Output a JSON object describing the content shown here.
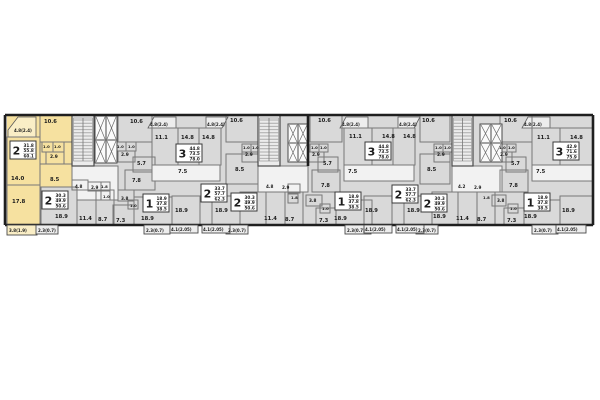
{
  "meta": {
    "description": "Residential building floor plan with highlighted apartment",
    "canvas": {
      "w": 600,
      "h": 400
    }
  },
  "colors": {
    "background": "#ffffff",
    "room_fill": "#d9d9d9",
    "highlight_fill": "#f6e1a0",
    "highlight_balcony_fill": "#faeec6",
    "white_room_fill": "#f2f2f2",
    "balcony_fill": "#ededed",
    "core_fill": "#ececec",
    "outer_wall": "#1f1f1f",
    "partition": "#787878",
    "label_color": "#1c1c1c"
  },
  "plan": {
    "outline": {
      "x": 5,
      "y": 115,
      "w": 588,
      "h": 110
    },
    "highlight": {
      "points": "7,115 72,115 72,200 40,200 40,225 7,225"
    },
    "walls": [
      [
        5,
        115,
        593,
        115
      ],
      [
        5,
        225,
        593,
        225
      ],
      [
        5,
        115,
        5,
        225
      ],
      [
        593,
        115,
        593,
        225
      ],
      [
        308,
        115,
        308,
        166
      ]
    ],
    "rooms": [
      [
        7,
        137,
        33,
        48,
        0
      ],
      [
        40,
        115,
        32,
        27,
        0
      ],
      [
        42,
        142,
        11,
        10,
        0
      ],
      [
        53,
        142,
        11,
        10,
        0
      ],
      [
        46,
        152,
        18,
        12,
        0
      ],
      [
        40,
        164,
        32,
        36,
        0
      ],
      [
        7,
        185,
        33,
        40,
        0
      ],
      [
        72,
        166,
        46,
        34,
        1
      ],
      [
        41,
        187,
        36,
        38,
        2
      ],
      [
        77,
        190,
        19,
        35,
        0
      ],
      [
        96,
        190,
        18,
        35,
        0
      ],
      [
        72,
        180,
        16,
        10,
        0
      ],
      [
        88,
        182,
        13,
        9,
        0
      ],
      [
        101,
        182,
        9,
        9,
        0
      ],
      [
        101,
        191,
        9,
        9,
        0
      ],
      [
        118,
        190,
        16,
        11,
        0
      ],
      [
        128,
        200,
        10,
        9,
        0
      ],
      [
        113,
        205,
        21,
        20,
        0
      ],
      [
        134,
        197,
        38,
        28,
        0
      ],
      [
        125,
        170,
        30,
        20,
        0
      ],
      [
        118,
        115,
        34,
        27,
        0
      ],
      [
        116,
        142,
        10,
        9,
        0
      ],
      [
        126,
        142,
        10,
        9,
        0
      ],
      [
        118,
        151,
        17,
        11,
        0
      ],
      [
        133,
        157,
        22,
        15,
        0
      ],
      [
        152,
        128,
        26,
        37,
        0
      ],
      [
        178,
        128,
        21,
        37,
        0
      ],
      [
        199,
        128,
        22,
        37,
        0
      ],
      [
        152,
        165,
        68,
        16,
        1
      ],
      [
        172,
        196,
        28,
        29,
        0
      ],
      [
        212,
        196,
        28,
        29,
        0
      ],
      [
        226,
        115,
        32,
        27,
        0
      ],
      [
        242,
        144,
        9,
        8,
        0
      ],
      [
        251,
        144,
        9,
        8,
        0
      ],
      [
        242,
        152,
        16,
        10,
        0
      ],
      [
        226,
        154,
        32,
        30,
        0
      ],
      [
        240,
        192,
        26,
        33,
        0
      ],
      [
        266,
        192,
        19,
        33,
        0
      ],
      [
        285,
        192,
        18,
        33,
        0
      ],
      [
        264,
        182,
        17,
        10,
        0
      ],
      [
        281,
        184,
        12,
        8,
        0
      ],
      [
        258,
        166,
        50,
        26,
        1
      ],
      [
        310,
        115,
        32,
        27,
        0
      ],
      [
        310,
        144,
        9,
        8,
        0
      ],
      [
        319,
        144,
        9,
        8,
        0
      ],
      [
        308,
        152,
        16,
        10,
        0
      ],
      [
        318,
        157,
        20,
        15,
        0
      ],
      [
        344,
        128,
        28,
        37,
        0
      ],
      [
        372,
        128,
        21,
        37,
        0
      ],
      [
        393,
        128,
        22,
        37,
        0
      ],
      [
        344,
        165,
        70,
        16,
        1
      ],
      [
        312,
        170,
        28,
        22,
        0
      ],
      [
        288,
        184,
        12,
        9,
        0
      ],
      [
        288,
        194,
        10,
        9,
        0
      ],
      [
        306,
        195,
        16,
        11,
        0
      ],
      [
        320,
        204,
        10,
        9,
        0
      ],
      [
        316,
        208,
        20,
        17,
        0
      ],
      [
        336,
        200,
        36,
        25,
        0
      ],
      [
        364,
        196,
        28,
        29,
        0
      ],
      [
        404,
        196,
        28,
        29,
        0
      ],
      [
        420,
        115,
        30,
        27,
        0
      ],
      [
        434,
        144,
        9,
        8,
        0
      ],
      [
        443,
        144,
        9,
        8,
        0
      ],
      [
        434,
        152,
        16,
        10,
        0
      ],
      [
        420,
        154,
        30,
        30,
        0
      ],
      [
        432,
        192,
        26,
        33,
        0
      ],
      [
        458,
        192,
        19,
        33,
        0
      ],
      [
        477,
        192,
        18,
        33,
        0
      ],
      [
        456,
        182,
        17,
        10,
        0
      ],
      [
        473,
        184,
        12,
        8,
        0
      ],
      [
        452,
        166,
        50,
        26,
        1
      ],
      [
        500,
        115,
        32,
        27,
        0
      ],
      [
        498,
        144,
        9,
        8,
        0
      ],
      [
        507,
        144,
        9,
        8,
        0
      ],
      [
        496,
        152,
        16,
        10,
        0
      ],
      [
        506,
        157,
        20,
        15,
        0
      ],
      [
        532,
        128,
        28,
        37,
        0
      ],
      [
        560,
        128,
        33,
        37,
        0
      ],
      [
        532,
        165,
        61,
        16,
        1
      ],
      [
        500,
        170,
        28,
        22,
        0
      ],
      [
        492,
        195,
        14,
        11,
        0
      ],
      [
        508,
        204,
        10,
        9,
        0
      ],
      [
        504,
        208,
        20,
        17,
        0
      ],
      [
        524,
        200,
        36,
        25,
        0
      ],
      [
        560,
        196,
        33,
        29,
        0
      ]
    ],
    "stairs": [
      [
        72,
        115,
        22,
        51
      ],
      [
        258,
        115,
        22,
        51
      ],
      [
        452,
        115,
        21,
        51
      ]
    ],
    "elevators": [
      [
        95,
        116,
        11,
        24
      ],
      [
        106,
        116,
        11,
        24
      ],
      [
        95,
        140,
        11,
        23
      ],
      [
        106,
        140,
        11,
        23
      ],
      [
        288,
        124,
        10,
        19
      ],
      [
        298,
        124,
        10,
        19
      ],
      [
        288,
        143,
        10,
        19
      ],
      [
        298,
        143,
        10,
        19
      ],
      [
        480,
        124,
        11,
        19
      ],
      [
        491,
        124,
        11,
        19
      ],
      [
        480,
        143,
        11,
        19
      ],
      [
        491,
        143,
        11,
        19
      ]
    ],
    "top_balconies": [
      {
        "points": "8,137 8,130 18,117 36,117 36,137",
        "type": "y"
      },
      {
        "points": "148,128 154,117 176,117 176,128",
        "type": "b"
      },
      {
        "points": "206,128 206,117 228,117 222,128",
        "type": "b"
      },
      {
        "points": "340,128 346,117 368,117 368,128",
        "type": "b"
      },
      {
        "points": "398,128 398,117 420,117 414,128",
        "type": "b"
      },
      {
        "points": "522,128 528,117 550,117 550,128",
        "type": "b"
      }
    ],
    "bottom_balconies": [
      [
        7,
        225,
        30,
        10,
        "y"
      ],
      [
        36,
        225,
        22,
        9,
        "p"
      ],
      [
        144,
        225,
        26,
        9,
        "p"
      ],
      [
        226,
        225,
        22,
        9,
        "p"
      ],
      [
        345,
        225,
        26,
        9,
        "p"
      ],
      [
        416,
        225,
        22,
        9,
        "p"
      ],
      [
        532,
        225,
        26,
        9,
        "p"
      ],
      [
        170,
        225,
        28,
        8,
        "l"
      ],
      [
        202,
        225,
        28,
        8,
        "l"
      ],
      [
        364,
        225,
        28,
        8,
        "l"
      ],
      [
        396,
        225,
        28,
        8,
        "l"
      ],
      [
        556,
        225,
        30,
        8,
        "l"
      ]
    ],
    "labels": [
      [
        44,
        123,
        "10.6",
        5.2
      ],
      [
        130,
        123,
        "10.6",
        5.2
      ],
      [
        230,
        122,
        "10.6",
        5.2
      ],
      [
        318,
        122,
        "10.6",
        5.2
      ],
      [
        422,
        122,
        "10.6",
        5.2
      ],
      [
        504,
        122,
        "10.6",
        5.2
      ],
      [
        11,
        180,
        "14.0",
        5.4
      ],
      [
        12,
        203,
        "17.8",
        5.4
      ],
      [
        155,
        139,
        "11.1",
        5.2
      ],
      [
        349,
        138,
        "11.1",
        5.2
      ],
      [
        537,
        139,
        "11.1",
        5.2
      ],
      [
        181,
        139,
        "14.8",
        5.2
      ],
      [
        202,
        139,
        "14.8",
        5.2
      ],
      [
        382,
        138,
        "14.8",
        5.2
      ],
      [
        403,
        138,
        "14.8",
        5.2
      ],
      [
        570,
        139,
        "14.8",
        5.2
      ],
      [
        55,
        218,
        "18.9",
        5.2
      ],
      [
        141,
        220,
        "18.9",
        5.2
      ],
      [
        175,
        212,
        "18.9",
        5.2
      ],
      [
        215,
        212,
        "18.9",
        5.2
      ],
      [
        334,
        220,
        "18.9",
        5.2
      ],
      [
        365,
        212,
        "18.9",
        5.2
      ],
      [
        407,
        212,
        "18.9",
        5.2
      ],
      [
        433,
        218,
        "18.9",
        5.2
      ],
      [
        524,
        218,
        "18.9",
        5.2
      ],
      [
        562,
        212,
        "18.9",
        5.2
      ],
      [
        79,
        220,
        "11.4",
        5.2
      ],
      [
        264,
        220,
        "11.4",
        5.2
      ],
      [
        456,
        220,
        "11.4",
        5.2
      ],
      [
        98,
        221,
        "8.7",
        5.2
      ],
      [
        285,
        221,
        "8.7",
        5.2
      ],
      [
        477,
        221,
        "8.7",
        5.2
      ],
      [
        116,
        222,
        "7.3",
        5.2
      ],
      [
        319,
        222,
        "7.3",
        5.2
      ],
      [
        507,
        222,
        "7.3",
        5.2
      ],
      [
        178,
        173,
        "7.5",
        5.2
      ],
      [
        348,
        173,
        "7.5",
        5.2
      ],
      [
        536,
        173,
        "7.5",
        5.2
      ],
      [
        50,
        181,
        "8.5",
        5.2
      ],
      [
        235,
        171,
        "8.5",
        5.2
      ],
      [
        427,
        171,
        "8.5",
        5.2
      ],
      [
        137,
        165,
        "5.7",
        5.0
      ],
      [
        323,
        165,
        "5.7",
        5.0
      ],
      [
        511,
        165,
        "5.7",
        5.0
      ],
      [
        132,
        182,
        "7.8",
        5.0
      ],
      [
        321,
        187,
        "7.8",
        5.0
      ],
      [
        509,
        187,
        "7.8",
        5.0
      ],
      [
        50,
        158,
        "2.9",
        4.4
      ],
      [
        121,
        156,
        "2.9",
        4.4
      ],
      [
        245,
        156,
        "2.9",
        4.4
      ],
      [
        312,
        156,
        "2.9",
        4.4
      ],
      [
        437,
        156,
        "2.9",
        4.4
      ],
      [
        500,
        156,
        "2.9",
        4.4
      ],
      [
        91,
        189,
        "2.9",
        4.2
      ],
      [
        282,
        189,
        "2.9",
        4.2
      ],
      [
        474,
        189,
        "2.9",
        4.2
      ],
      [
        75,
        188,
        "4.8",
        4.2
      ],
      [
        266,
        188,
        "4.8",
        4.2
      ],
      [
        458,
        188,
        "4.2",
        4.2
      ],
      [
        121,
        200,
        "3.8",
        4.2
      ],
      [
        309,
        202,
        "3.8",
        4.2
      ],
      [
        497,
        202,
        "3.8",
        4.2
      ],
      [
        101,
        188,
        "1.8",
        3.8
      ],
      [
        291,
        199,
        "1.8",
        3.8
      ],
      [
        483,
        199,
        "1.8",
        3.8
      ],
      [
        43,
        148,
        "1.0",
        3.8
      ],
      [
        54,
        148,
        "1.0",
        3.8
      ],
      [
        117,
        148,
        "1.0",
        3.8
      ],
      [
        128,
        148,
        "1.0",
        3.8
      ],
      [
        243,
        149,
        "1.0",
        3.8
      ],
      [
        252,
        149,
        "1.0",
        3.8
      ],
      [
        311,
        149,
        "1.0",
        3.8
      ],
      [
        320,
        149,
        "1.0",
        3.8
      ],
      [
        435,
        149,
        "1.0",
        3.8
      ],
      [
        444,
        149,
        "1.0",
        3.8
      ],
      [
        499,
        149,
        "1.0",
        3.8
      ],
      [
        508,
        149,
        "1.0",
        3.8
      ],
      [
        103,
        198,
        "1.0",
        3.8
      ],
      [
        130,
        207,
        "1.0",
        3.8
      ],
      [
        322,
        210,
        "1.0",
        3.8
      ],
      [
        510,
        210,
        "1.0",
        3.8
      ],
      [
        14,
        132,
        "4.8(2.4)",
        4.0
      ],
      [
        150,
        126,
        "4.8(2.4)",
        4.0
      ],
      [
        207,
        126,
        "4.8(2.4)",
        4.0
      ],
      [
        342,
        126,
        "4.8(2.4)",
        4.0
      ],
      [
        399,
        126,
        "4.8(2.4)",
        4.0
      ],
      [
        524,
        126,
        "4.8(2.4)",
        4.0
      ],
      [
        9,
        232,
        "3.8(1.9)",
        4.0
      ],
      [
        38,
        232,
        "2.3(0.7)",
        4.0
      ],
      [
        146,
        232,
        "2.3(0.7)",
        4.0
      ],
      [
        228,
        232,
        "2.3(0.7)",
        4.0
      ],
      [
        347,
        232,
        "2.3(0.7)",
        4.0
      ],
      [
        418,
        232,
        "2.3(0.7)",
        4.0
      ],
      [
        534,
        232,
        "2.3(0.7)",
        4.0
      ],
      [
        171,
        231,
        "4.1(2.05)",
        4.0
      ],
      [
        203,
        231,
        "4.1(2.05)",
        4.0
      ],
      [
        365,
        231,
        "4.1(2.05)",
        4.0
      ],
      [
        397,
        231,
        "4.1(2.05)",
        4.0
      ],
      [
        557,
        231,
        "4.1(2.05)",
        4.0
      ]
    ],
    "badges": [
      {
        "x": 10,
        "y": 141,
        "num": "2",
        "values": [
          "31.8",
          "55.8",
          "60.1"
        ],
        "highlighted": true
      },
      {
        "x": 42,
        "y": 191,
        "num": "2",
        "values": [
          "30.3",
          "49.9",
          "50.6"
        ],
        "highlighted": false
      },
      {
        "x": 143,
        "y": 194,
        "num": "1",
        "values": [
          "18.9",
          "37.8",
          "38.5"
        ],
        "highlighted": false
      },
      {
        "x": 176,
        "y": 144,
        "num": "3",
        "values": [
          "44.8",
          "73.5",
          "78.0"
        ],
        "highlighted": false
      },
      {
        "x": 201,
        "y": 184,
        "num": "2",
        "values": [
          "33.7",
          "57.7",
          "62.3"
        ],
        "highlighted": false
      },
      {
        "x": 231,
        "y": 193,
        "num": "2",
        "values": [
          "30.3",
          "49.9",
          "50.6"
        ],
        "highlighted": false
      },
      {
        "x": 335,
        "y": 192,
        "num": "1",
        "values": [
          "18.9",
          "37.8",
          "38.5"
        ],
        "highlighted": false
      },
      {
        "x": 365,
        "y": 142,
        "num": "3",
        "values": [
          "44.8",
          "73.5",
          "78.0"
        ],
        "highlighted": false
      },
      {
        "x": 392,
        "y": 185,
        "num": "2",
        "values": [
          "33.7",
          "57.7",
          "62.3"
        ],
        "highlighted": false
      },
      {
        "x": 421,
        "y": 194,
        "num": "2",
        "values": [
          "30.3",
          "49.9",
          "50.6"
        ],
        "highlighted": false
      },
      {
        "x": 524,
        "y": 193,
        "num": "1",
        "values": [
          "18.9",
          "37.8",
          "38.5"
        ],
        "highlighted": false
      },
      {
        "x": 553,
        "y": 142,
        "num": "3",
        "values": [
          "42.9",
          "71.6",
          "75.9"
        ],
        "highlighted": false
      }
    ]
  }
}
